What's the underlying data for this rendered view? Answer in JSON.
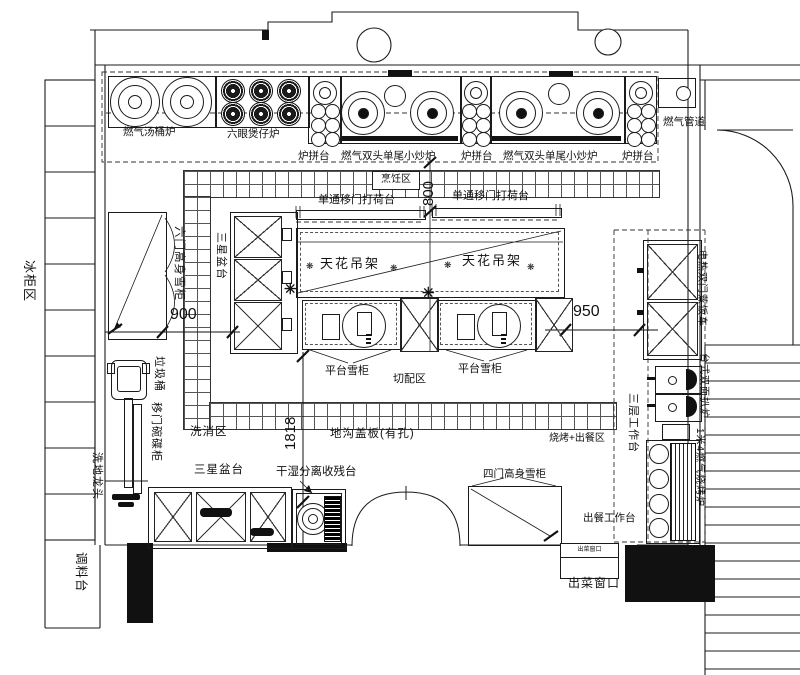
{
  "plan": {
    "cookline": {
      "units": [
        "燃气汤桶炉",
        "六眼煲仔炉",
        "炉拼台",
        "燃气双头单尾小炒炉",
        "炉拼台",
        "燃气双头单尾小炒炉",
        "炉拼台"
      ],
      "gas_pipe": "燃气管道"
    },
    "zones": {
      "cooking": "烹饪区",
      "washing": "洗消区",
      "cutting": "切配区",
      "bbq_serving": "烧烤+出餐区",
      "freezer_area": "冰柜区",
      "seasoning": "调料台"
    },
    "island": {
      "pass_left": "单通移门打荷台",
      "pass_right": "单通移门打荷台",
      "rack_left": "天花吊架",
      "rack_right": "天花吊架",
      "fridge_left": "平台雪柜",
      "fridge_right": "平台雪柜",
      "sink3": "三星盆台"
    },
    "left": {
      "tall_freezer": "六门高身雪柜",
      "trash": "垃圾桶",
      "dish_cabinet": "移门碗碟柜",
      "floor_faucet": "洗地龙头"
    },
    "bottom": {
      "trench": "地沟盖板(有孔)",
      "sink3": "三星盆台",
      "waste_table": "干湿分离收残台",
      "freezer4": "四门高身雪柜",
      "serve_table": "出餐工作台",
      "window_box": "出菜窗口",
      "window": "出菜窗口"
    },
    "right": {
      "tier3": "三层工作台",
      "steamer": "电热双门蒸饭车",
      "griddle": "台式双面扒炉",
      "bbq": "1米4燃气烧烤炉"
    },
    "dims": {
      "d900": "900",
      "d950": "950",
      "d1818": "1818",
      "d800": "800"
    },
    "symbols": {
      "star": "✳",
      "flower": "❋"
    }
  }
}
